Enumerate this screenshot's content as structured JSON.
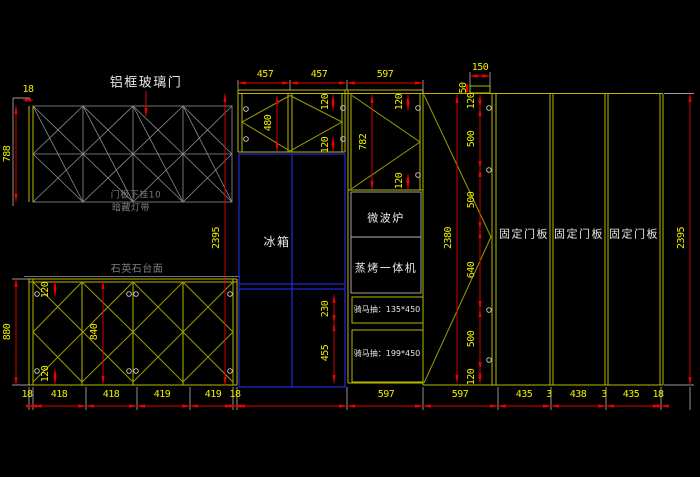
{
  "drawing": {
    "title_note": "kitchen cabinet elevation",
    "annotations": {
      "glass_door": "铝框玻璃门",
      "door_note_line1": "门板下挂10",
      "door_note_line2": "暗藏灯带",
      "countertop": "石英石台面",
      "fridge": "冰箱",
      "microwave": "微波炉",
      "steam_oven": "蒸烤一体机",
      "drawer_top": "骑马抽：135*450",
      "drawer_bottom": "骑马抽：199*450"
    },
    "panels": [
      "固定门板",
      "固定门板",
      "固定门板"
    ],
    "dims": {
      "top": [
        "457",
        "457",
        "597"
      ],
      "top_150": "150",
      "top_50": "50",
      "top_left_18": "18",
      "left_788": "788",
      "left_2395": "2395",
      "right_2395": "2395",
      "base_880": "880",
      "base_left": [
        "120",
        "840",
        "120"
      ],
      "upper_480": "480",
      "upper_120a": "120",
      "upper_120b": "120",
      "mid_782": "782",
      "mid_120a": "120",
      "mid_120b": "120",
      "mid_230": "230",
      "mid_455": "455",
      "tall_2380": "2380",
      "tall_chain": [
        "120",
        "500",
        "500",
        "640",
        "500",
        "120"
      ],
      "bottom_left": [
        "18",
        "418",
        "418",
        "419",
        "419",
        "18"
      ],
      "bottom_mid": [
        "597",
        "597"
      ],
      "bottom_right": [
        "435",
        "3",
        "438",
        "3",
        "435",
        "18"
      ]
    },
    "colors": {
      "background": "#000000",
      "cabinet_line": "#b9b900",
      "swing_line": "#9c9c00",
      "dimension_line": "#e60000",
      "dimension_text": "#efef00",
      "appliance_box": "#2424cf",
      "glass_door_line": "#8f8f8f",
      "label_text": "#e8e8e8"
    }
  }
}
